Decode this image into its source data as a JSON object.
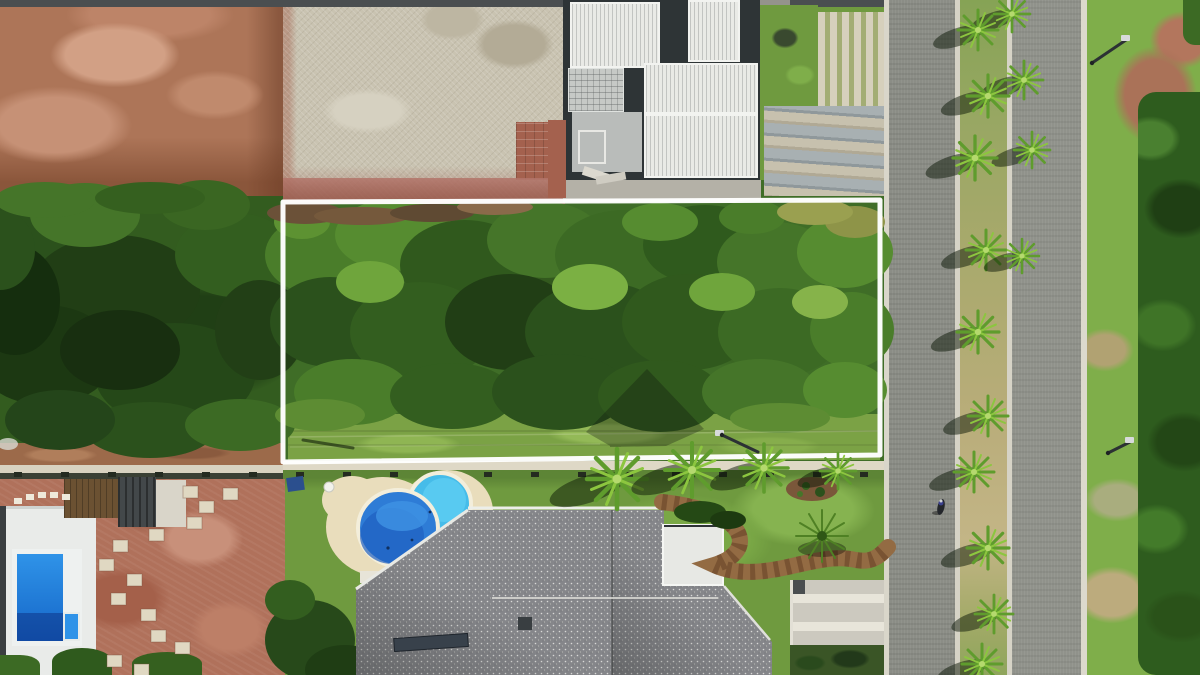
{
  "meta": {
    "type": "aerial-drone-photo",
    "subject": "vacant residential land lot outlined in white, tree-covered, between houses and a palm-lined divided street",
    "canvas_w": 1200,
    "canvas_h": 675
  },
  "palette": {
    "boundary": "#ffffff",
    "canopy-base": "#3f6d27",
    "lawn": "#6f9a3f",
    "asphalt": "#8b8d86",
    "curb": "#d9d6ca",
    "gravel": "#c9c3b1",
    "dirt": "#ad7558",
    "dirt-yard": "#b0715b",
    "deck": "#e9ddbc",
    "roof-gray": "#85868a",
    "roof-white": "#e9eae6",
    "pool-blue": "#2e7cd6",
    "pool-cyan": "#46bce9",
    "shrub-dark": "#2e5c1e",
    "sidewalk": "#ded8c6",
    "slab-white": "#e9ebe9",
    "path-brown": "#936b43"
  },
  "scene": {
    "boundary": {
      "points_str": "283,202 880,200 880,455 283,462",
      "stroke_width": 5
    },
    "canopy_blobs": [
      [
        35,
        235,
        65,
        40,
        "#2b511c"
      ],
      [
        115,
        290,
        85,
        55,
        "#213e15"
      ],
      [
        45,
        355,
        70,
        50,
        "#1c3812"
      ],
      [
        175,
        375,
        80,
        52,
        "#254818"
      ],
      [
        235,
        255,
        60,
        42,
        "#335e1f"
      ],
      [
        85,
        215,
        55,
        32,
        "#457529"
      ],
      [
        15,
        300,
        45,
        55,
        "#152e0e"
      ],
      [
        150,
        430,
        65,
        28,
        "#2b511c"
      ],
      [
        240,
        425,
        55,
        26,
        "#3c6a24"
      ],
      [
        205,
        205,
        45,
        25,
        "#3a6622"
      ],
      [
        260,
        330,
        45,
        50,
        "#223f16"
      ],
      [
        120,
        350,
        60,
        40,
        "#182f10"
      ],
      [
        60,
        420,
        55,
        30,
        "#24451a"
      ],
      [
        0,
        250,
        35,
        40,
        "#2b511c"
      ],
      [
        45,
        200,
        50,
        18,
        "#457529"
      ],
      [
        150,
        198,
        55,
        16,
        "#35601f"
      ],
      [
        320,
        255,
        55,
        40,
        "#4a7d2a"
      ],
      [
        395,
        235,
        60,
        36,
        "#568c30"
      ],
      [
        465,
        265,
        65,
        45,
        "#30591d"
      ],
      [
        545,
        240,
        58,
        38,
        "#457529"
      ],
      [
        625,
        255,
        70,
        45,
        "#3c6a24"
      ],
      [
        705,
        245,
        62,
        40,
        "#2f5a1d"
      ],
      [
        775,
        262,
        58,
        40,
        "#457529"
      ],
      [
        845,
        252,
        48,
        36,
        "#568c30"
      ],
      [
        330,
        322,
        60,
        45,
        "#2b511c"
      ],
      [
        420,
        332,
        70,
        50,
        "#335e1f"
      ],
      [
        510,
        322,
        65,
        48,
        "#213e15"
      ],
      [
        600,
        332,
        75,
        50,
        "#2b511c"
      ],
      [
        690,
        322,
        68,
        48,
        "#30591d"
      ],
      [
        780,
        332,
        62,
        44,
        "#3c6a24"
      ],
      [
        852,
        330,
        42,
        38,
        "#4a7d2a"
      ],
      [
        352,
        392,
        58,
        33,
        "#4a7d2a"
      ],
      [
        452,
        396,
        62,
        33,
        "#335e1f"
      ],
      [
        560,
        392,
        68,
        38,
        "#2b511c"
      ],
      [
        660,
        396,
        62,
        36,
        "#30591d"
      ],
      [
        760,
        392,
        58,
        33,
        "#457529"
      ],
      [
        845,
        390,
        42,
        28,
        "#568c30"
      ],
      [
        370,
        282,
        34,
        21,
        "#6fa53c"
      ],
      [
        590,
        287,
        38,
        23,
        "#7bb043"
      ],
      [
        722,
        292,
        33,
        19,
        "#6fa53c"
      ],
      [
        820,
        302,
        28,
        17,
        "#86b34a"
      ],
      [
        302,
        222,
        28,
        17,
        "#5d9232"
      ],
      [
        660,
        222,
        38,
        19,
        "#568c30"
      ],
      [
        752,
        217,
        33,
        17,
        "#4a7d2a"
      ],
      [
        855,
        222,
        30,
        16,
        "#8e9448"
      ],
      [
        815,
        212,
        38,
        13,
        "#9aa050"
      ],
      [
        305,
        213,
        38,
        11,
        "#6b5138"
      ],
      [
        362,
        216,
        48,
        9,
        "#75593c"
      ],
      [
        432,
        213,
        42,
        9,
        "#5f4a33"
      ],
      [
        495,
        207,
        38,
        8,
        "#8a6a4a"
      ],
      [
        320,
        415,
        45,
        16,
        "#5d8c33"
      ],
      [
        780,
        418,
        50,
        15,
        "#5d8c33"
      ],
      [
        310,
        640,
        45,
        40,
        "#27491a"
      ],
      [
        345,
        670,
        40,
        25,
        "#1f3d14"
      ],
      [
        290,
        600,
        25,
        20,
        "#335e1f"
      ]
    ],
    "median_palms": [
      {
        "x": 1012,
        "y": 14,
        "s": 0.9
      },
      {
        "x": 978,
        "y": 30,
        "s": 1.0
      },
      {
        "x": 1024,
        "y": 80,
        "s": 0.95
      },
      {
        "x": 988,
        "y": 96,
        "s": 1.05
      },
      {
        "x": 1032,
        "y": 150,
        "s": 0.9
      },
      {
        "x": 975,
        "y": 158,
        "s": 1.1
      },
      {
        "x": 986,
        "y": 250,
        "s": 1.0
      },
      {
        "x": 1022,
        "y": 256,
        "s": 0.85
      },
      {
        "x": 978,
        "y": 332,
        "s": 1.05
      },
      {
        "x": 988,
        "y": 416,
        "s": 1.0
      },
      {
        "x": 974,
        "y": 472,
        "s": 1.0
      },
      {
        "x": 988,
        "y": 548,
        "s": 1.05
      },
      {
        "x": 994,
        "y": 614,
        "s": 0.95
      },
      {
        "x": 982,
        "y": 664,
        "s": 1.0
      }
    ],
    "lawn_palms": [
      {
        "x": 617,
        "y": 479,
        "s": 1.5
      },
      {
        "x": 692,
        "y": 470,
        "s": 1.35
      },
      {
        "x": 764,
        "y": 468,
        "s": 1.2
      },
      {
        "x": 838,
        "y": 471,
        "s": 0.9
      }
    ],
    "cycad": {
      "x": 822,
      "y": 536
    },
    "paver_squares": [
      [
        183,
        486
      ],
      [
        199,
        501
      ],
      [
        187,
        517
      ],
      [
        149,
        529
      ],
      [
        113,
        540
      ],
      [
        99,
        559
      ],
      [
        127,
        574
      ],
      [
        111,
        593
      ],
      [
        141,
        609
      ],
      [
        151,
        630
      ],
      [
        175,
        642
      ],
      [
        107,
        655
      ],
      [
        134,
        664
      ],
      [
        223,
        488
      ]
    ],
    "stepping_stones": [
      [
        14,
        498
      ],
      [
        26,
        494
      ],
      [
        38,
        492
      ],
      [
        50,
        492
      ],
      [
        62,
        494
      ]
    ],
    "fence_posts": {
      "x_start": 14,
      "x_step": 47,
      "count": 19,
      "y": 472,
      "w": 8,
      "h": 5,
      "color": "#242b20"
    },
    "street_lamps": [
      {
        "x1": 1092,
        "y1": 63,
        "x2": 1126,
        "y2": 40,
        "hx": 1126,
        "hy": 38
      },
      {
        "x1": 1108,
        "y1": 453,
        "x2": 1130,
        "y2": 442,
        "hx": 1130,
        "hy": 440
      },
      {
        "x1": 722,
        "y1": 435,
        "x2": 758,
        "y2": 452,
        "hx": 720,
        "hy": 433
      }
    ],
    "motorcycle": {
      "x": 941,
      "y": 507
    },
    "watermark": {
      "opacity": 0.3
    }
  }
}
